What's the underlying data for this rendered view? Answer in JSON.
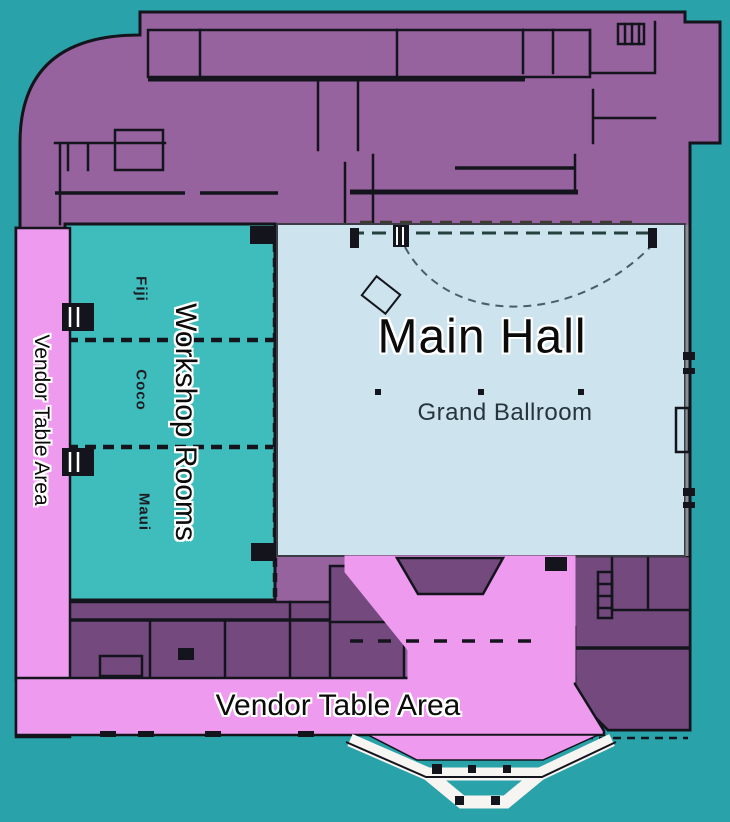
{
  "palette": {
    "background": "#2aa2aa",
    "building": "#96639e",
    "rooms_dark": "#74497e",
    "walls": "#14141d",
    "workshop_teal": "#3fbcbc",
    "main_hall_blue": "#cde4ee",
    "vendor_pink": "#ee9bef",
    "entrance_white": "#f7f5f2"
  },
  "regions": {
    "main_hall": {
      "label": "Main Hall",
      "room_name": "Grand Ballroom"
    },
    "workshop": {
      "label": "Workshop Rooms",
      "rooms": [
        {
          "name": "Fiji"
        },
        {
          "name": "Coco"
        },
        {
          "name": "Maui"
        }
      ]
    },
    "vendor_left": {
      "label": "Vendor Table Area"
    },
    "vendor_bottom": {
      "label": "Vendor Table Area"
    }
  }
}
